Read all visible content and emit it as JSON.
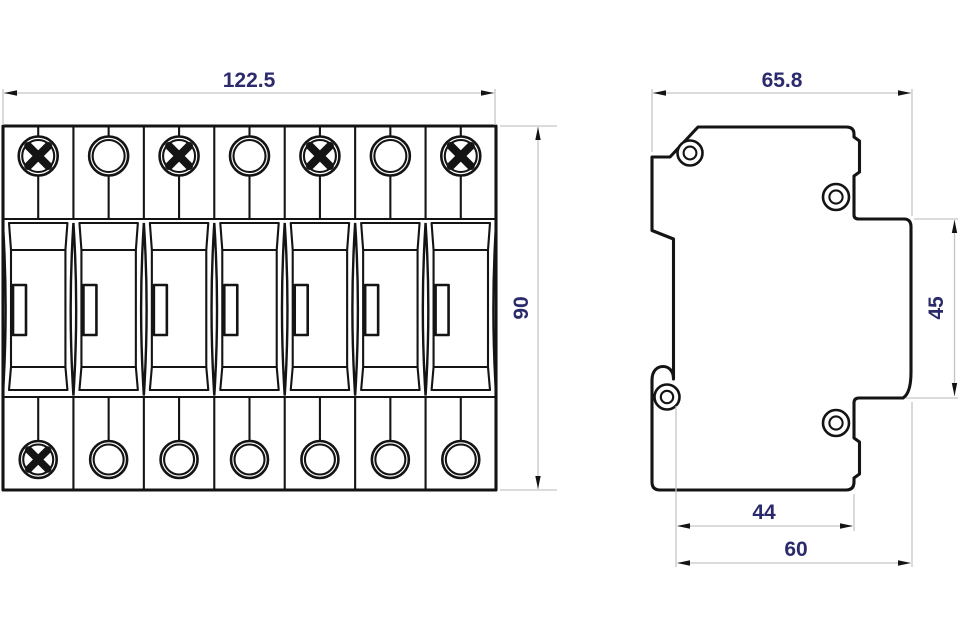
{
  "front_view": {
    "module_count": 7,
    "width_label": "122.5",
    "height_label": "90",
    "top_screws": [
      true,
      false,
      true,
      false,
      true,
      false,
      true
    ],
    "bottom_screws": [
      true,
      false,
      false,
      false,
      false,
      false,
      false
    ],
    "screw_icon": "phillips-cross-screw-head",
    "terminal_icon": "round-terminal-hole"
  },
  "side_view": {
    "width_label": "65.8",
    "step_height_label": "45",
    "bottom_inner_label": "44",
    "bottom_outer_label": "60",
    "hole_icon": "round-hole"
  },
  "colors": {
    "outline": "#141414",
    "dimension_line": "#c5c5c5",
    "dimension_text": "#2b2b6b",
    "background": "#ffffff"
  }
}
